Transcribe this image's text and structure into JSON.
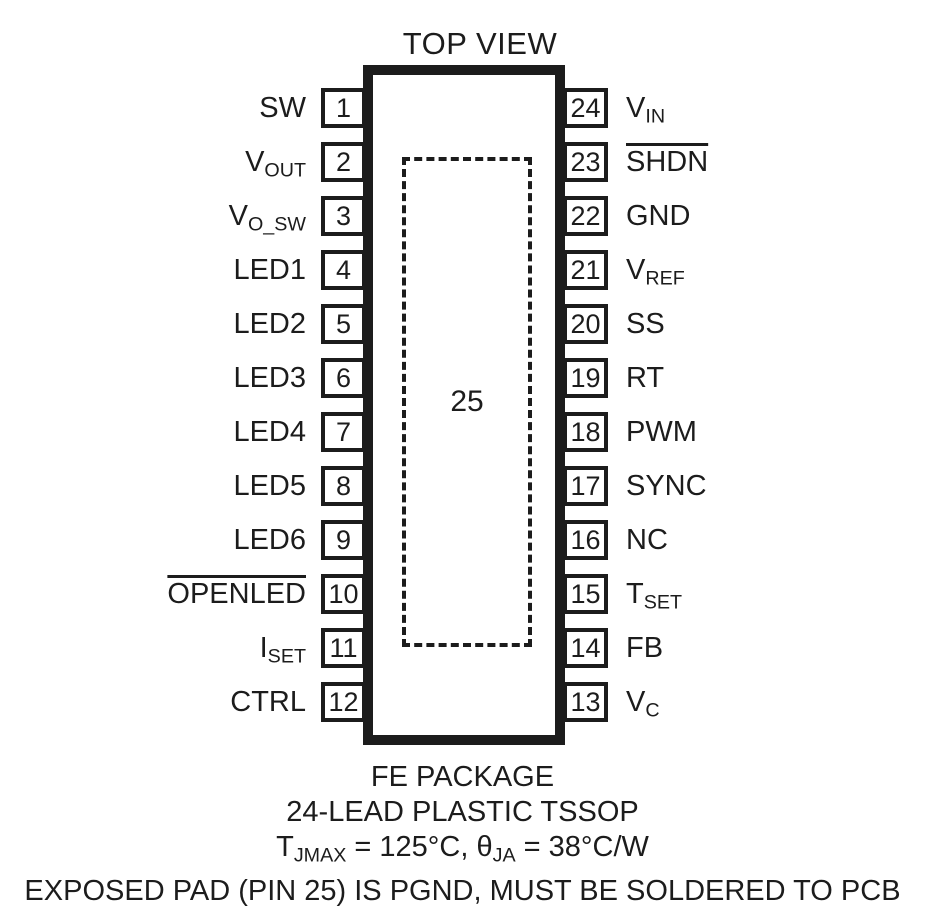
{
  "title": "TOP VIEW",
  "package": {
    "exposed_pad_number": "25",
    "lead_count": 24
  },
  "pins_left": [
    {
      "num": "1",
      "label": [
        {
          "t": "SW"
        }
      ]
    },
    {
      "num": "2",
      "label": [
        {
          "t": "V"
        },
        {
          "t": "OUT",
          "sub": true
        }
      ]
    },
    {
      "num": "3",
      "label": [
        {
          "t": "V"
        },
        {
          "t": "O_SW",
          "sub": true
        }
      ]
    },
    {
      "num": "4",
      "label": [
        {
          "t": "LED1"
        }
      ]
    },
    {
      "num": "5",
      "label": [
        {
          "t": "LED2"
        }
      ]
    },
    {
      "num": "6",
      "label": [
        {
          "t": "LED3"
        }
      ]
    },
    {
      "num": "7",
      "label": [
        {
          "t": "LED4"
        }
      ]
    },
    {
      "num": "8",
      "label": [
        {
          "t": "LED5"
        }
      ]
    },
    {
      "num": "9",
      "label": [
        {
          "t": "LED6"
        }
      ]
    },
    {
      "num": "10",
      "label": [
        {
          "t": "OPENLED",
          "over": true
        }
      ]
    },
    {
      "num": "11",
      "label": [
        {
          "t": "I"
        },
        {
          "t": "SET",
          "sub": true
        }
      ]
    },
    {
      "num": "12",
      "label": [
        {
          "t": "CTRL"
        }
      ]
    }
  ],
  "pins_right": [
    {
      "num": "24",
      "label": [
        {
          "t": "V"
        },
        {
          "t": "IN",
          "sub": true
        }
      ]
    },
    {
      "num": "23",
      "label": [
        {
          "t": "SHDN",
          "over": true
        }
      ]
    },
    {
      "num": "22",
      "label": [
        {
          "t": "GND"
        }
      ]
    },
    {
      "num": "21",
      "label": [
        {
          "t": "V"
        },
        {
          "t": "REF",
          "sub": true
        }
      ]
    },
    {
      "num": "20",
      "label": [
        {
          "t": "SS"
        }
      ]
    },
    {
      "num": "19",
      "label": [
        {
          "t": "RT"
        }
      ]
    },
    {
      "num": "18",
      "label": [
        {
          "t": "PWM"
        }
      ]
    },
    {
      "num": "17",
      "label": [
        {
          "t": "SYNC"
        }
      ]
    },
    {
      "num": "16",
      "label": [
        {
          "t": "NC"
        }
      ]
    },
    {
      "num": "15",
      "label": [
        {
          "t": "T"
        },
        {
          "t": "SET",
          "sub": true
        }
      ]
    },
    {
      "num": "14",
      "label": [
        {
          "t": "FB"
        }
      ]
    },
    {
      "num": "13",
      "label": [
        {
          "t": "V"
        },
        {
          "t": "C",
          "sub": true
        }
      ]
    }
  ],
  "caption": {
    "lines": [
      [
        {
          "t": "FE PACKAGE"
        }
      ],
      [
        {
          "t": "24-LEAD PLASTIC TSSOP"
        }
      ],
      [
        {
          "t": "T"
        },
        {
          "t": "JMAX",
          "sub": true
        },
        {
          "t": " = 125°C, "
        },
        {
          "t": "θ"
        },
        {
          "t": "JA",
          "sub": true
        },
        {
          "t": " = 38°C/W"
        }
      ],
      [
        {
          "t": "EXPOSED PAD (PIN 25) IS PGND, MUST BE SOLDERED TO PCB"
        }
      ]
    ]
  },
  "colors": {
    "ink": "#1c1c1c",
    "background": "#ffffff"
  }
}
